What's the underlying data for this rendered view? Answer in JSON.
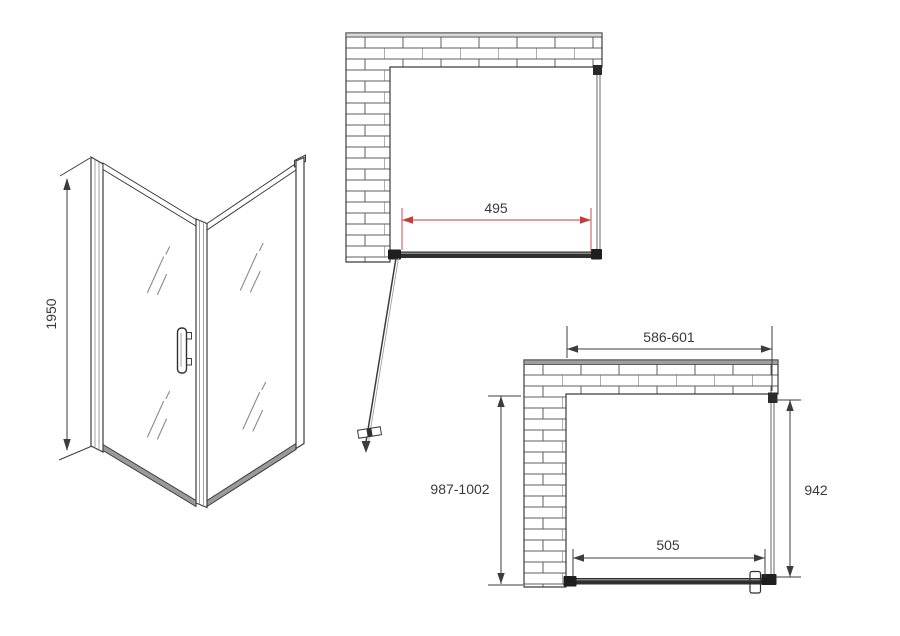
{
  "labels": {
    "side_height": "1950",
    "top_door_width": "495",
    "bottom_top_width": "586-601",
    "bottom_left_height": "987-1002",
    "bottom_right_height": "942",
    "bottom_door_width": "505"
  },
  "colors": {
    "dimension_red": "#c43c3c",
    "line_black": "#3c3c3c",
    "wall_strip_top_view": "#d9d9d9",
    "wall_strip_bottom_view": "#9f9f9f",
    "profile_dark": "#2f2f2f"
  },
  "icons": {
    "dimension_arrow": "filled-triangle",
    "door_swing_arrow": "filled-triangle-down"
  }
}
